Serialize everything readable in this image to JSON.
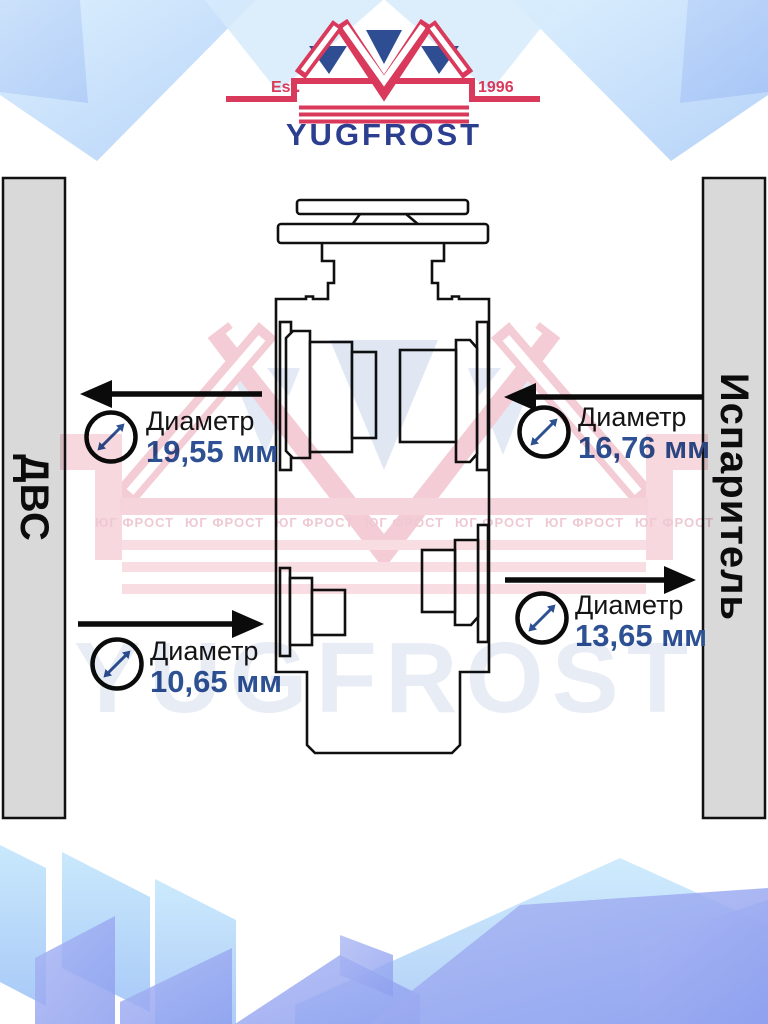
{
  "brand": {
    "name": "YUGFROST",
    "est_label": "Est.",
    "year": "1996",
    "watermark_text": "YUGFROST",
    "watermark_row": "ЮГ ФРОСТ",
    "colors": {
      "logo_red": "#d9395b",
      "logo_blue": "#2c3e8f",
      "triangle_blue": "#2e4d92"
    }
  },
  "diagram": {
    "left_bar_label": "ДВС",
    "right_bar_label": "Испаритель",
    "bar_fill": "#d9d9d9",
    "line_color": "#101010",
    "value_color": "#2d5193",
    "ports": [
      {
        "id": "upper-left",
        "label": "Диаметр",
        "value": "19,55 мм",
        "arrow_direction": "left"
      },
      {
        "id": "upper-right",
        "label": "Диаметр",
        "value": "16,76 мм",
        "arrow_direction": "left"
      },
      {
        "id": "lower-left",
        "label": "Диаметр",
        "value": "10,65 мм",
        "arrow_direction": "right"
      },
      {
        "id": "lower-right",
        "label": "Диаметр",
        "value": "13,65 мм",
        "arrow_direction": "right"
      }
    ]
  }
}
